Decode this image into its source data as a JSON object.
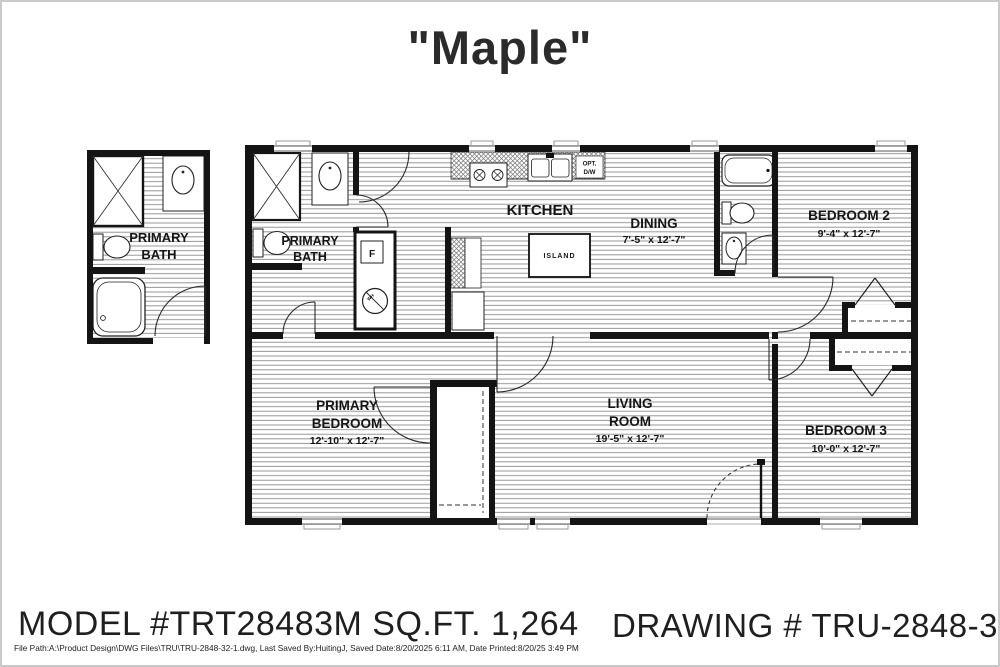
{
  "title": "\"Maple\"",
  "plan": {
    "detail_bath": {
      "line1": "PRIMARY",
      "line2": "BATH"
    },
    "rooms": {
      "primary_bath": {
        "line1": "PRIMARY",
        "line2": "BATH"
      },
      "kitchen": {
        "name": "KITCHEN"
      },
      "dining": {
        "name": "DINING",
        "dims": "7'-5\" x  12'-7\""
      },
      "bedroom2": {
        "name": "BEDROOM 2",
        "dims": "9'-4\" x  12'-7\""
      },
      "island": {
        "name": "ISLAND"
      },
      "primary_bedroom": {
        "line1": "PRIMARY",
        "line2": "BEDROOM",
        "dims": "12'-10\" x  12'-7\""
      },
      "living_room": {
        "line1": "LIVING",
        "line2": "ROOM",
        "dims": "19'-5\" x  12'-7\""
      },
      "bedroom3": {
        "name": "BEDROOM 3",
        "dims": "10'-0\" x  12'-7\""
      }
    },
    "labels": {
      "opt": "OPT.",
      "dw": "D/W",
      "furnace": "F",
      "water_heater": "WH"
    }
  },
  "footer": {
    "model": "MODEL #TRT28483M SQ.FT. 1,264",
    "drawing": "DRAWING # TRU-2848-32-1",
    "file_info": "File Path:A:\\Product Design\\DWG Files\\TRU\\TRU-2848-32-1.dwg, Last Saved By:HuitingJ, Saved Date:8/20/2025 6:11 AM, Date Printed:8/20/25 3:49 PM"
  }
}
